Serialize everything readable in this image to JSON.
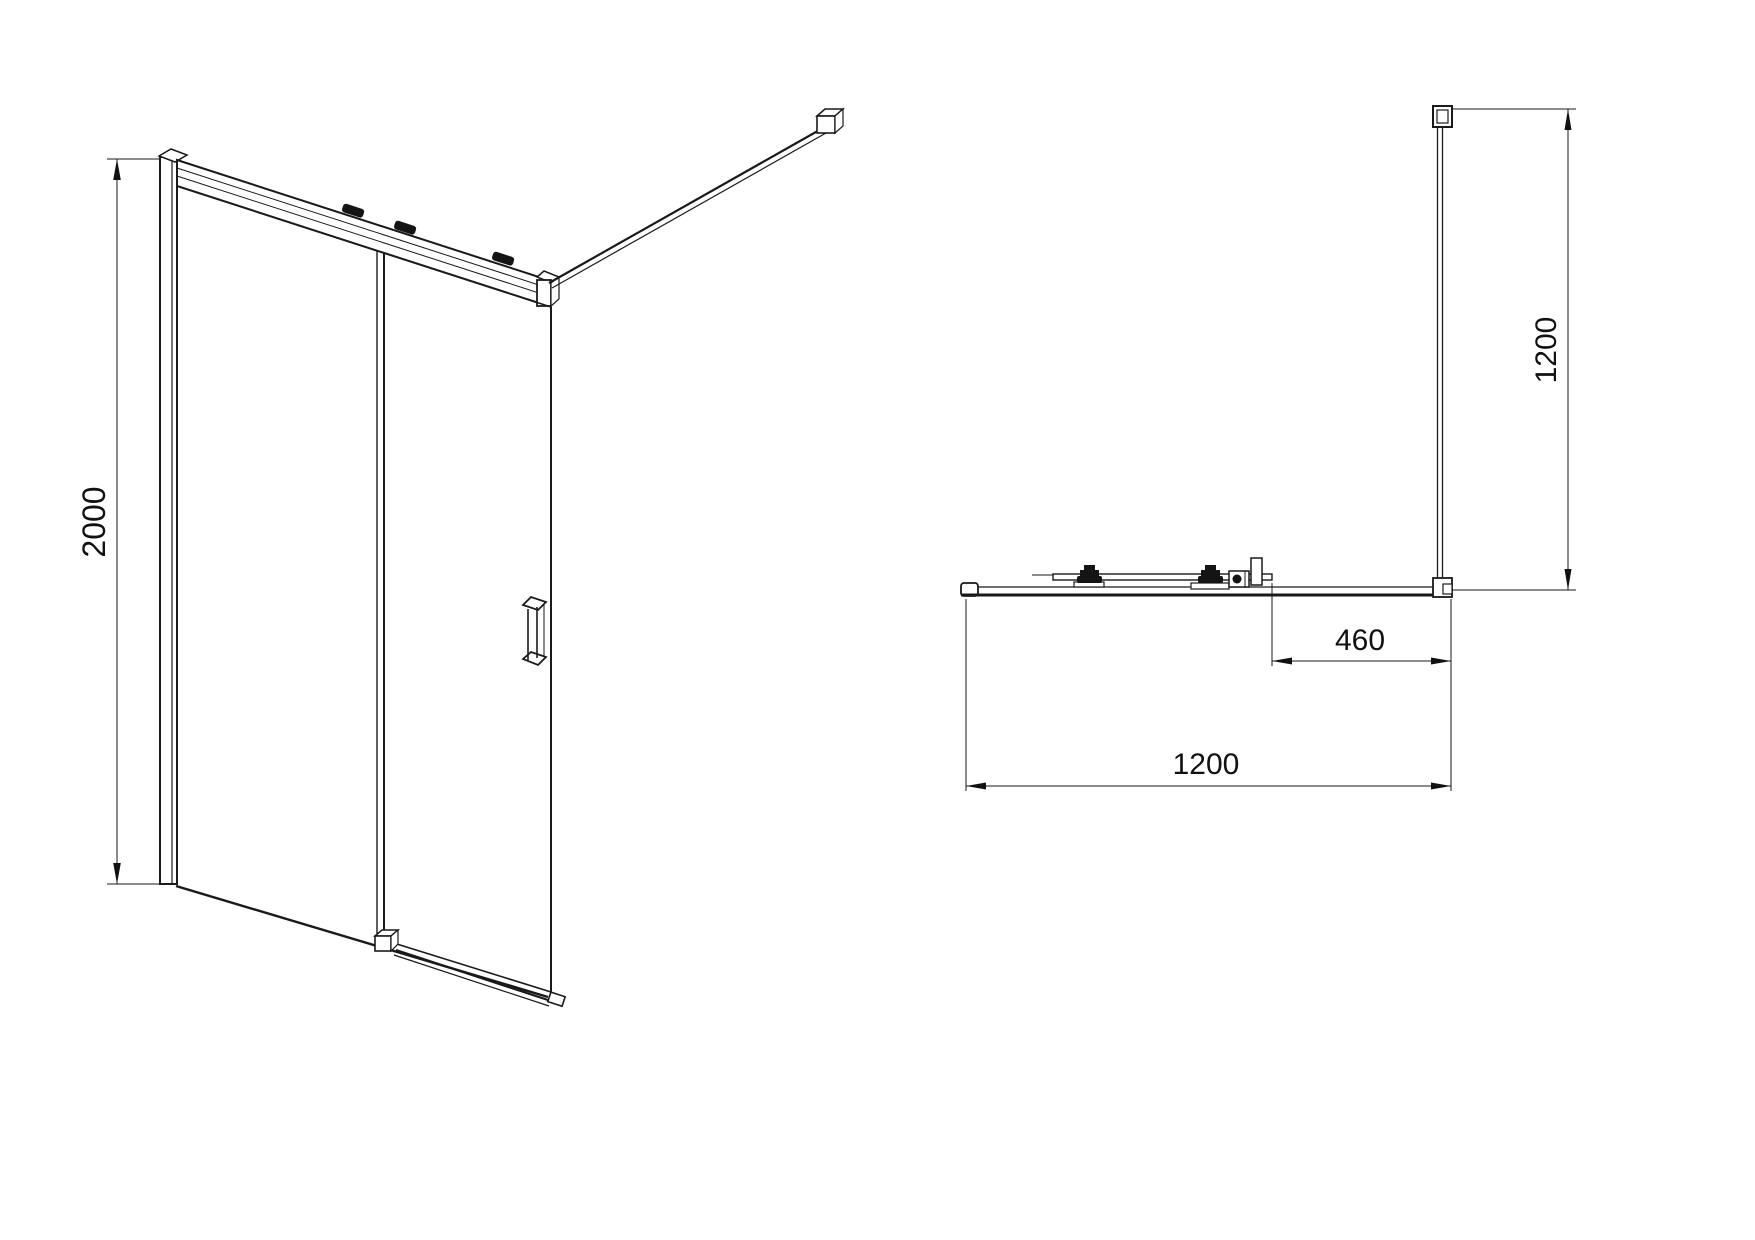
{
  "page": {
    "background": "#ffffff",
    "ink": "#1a1a1a"
  },
  "drawing": {
    "kind": "technical-line-drawing",
    "subject": "walk-in sliding shower door with support bar",
    "front_view": {
      "dim_height": {
        "label": "2000"
      }
    },
    "plan_view": {
      "dim_depth": {
        "label": "1200"
      },
      "dim_bar_offset": {
        "label": "460"
      },
      "dim_width": {
        "label": "1200"
      }
    }
  }
}
